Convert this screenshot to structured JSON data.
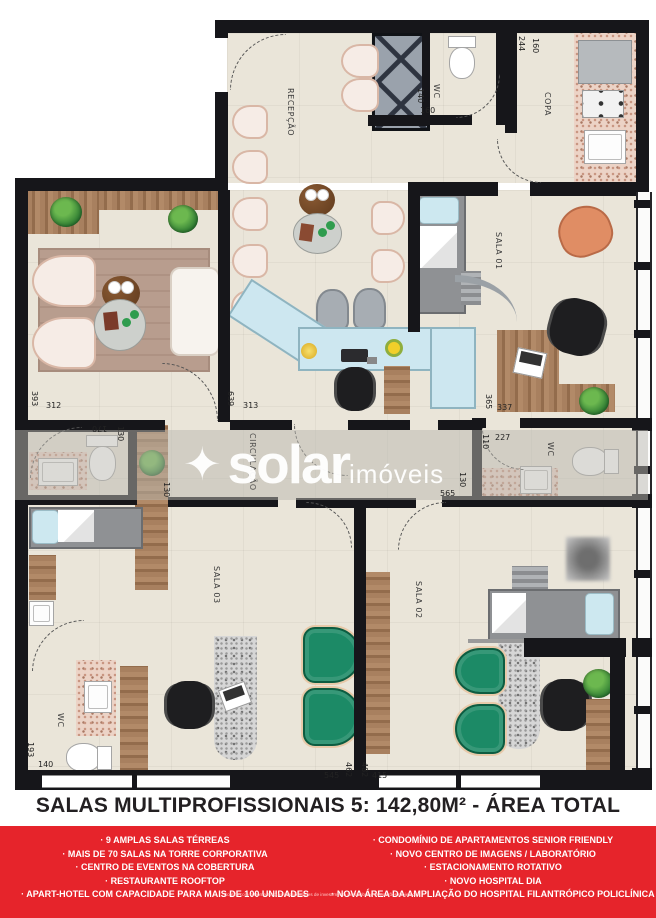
{
  "title": "SALAS MULTIPROFISSIONAIS 5: 142,80M² - ÁREA TOTAL",
  "watermark": {
    "icon": "✦",
    "brand": "solar",
    "suffix": "imóveis"
  },
  "rooms": {
    "recepcao": "RECEPÇÃO",
    "copa": "COPA",
    "wc_top": "WC",
    "sala01": "SALA 01",
    "sala02": "SALA 02",
    "sala03": "SALA 03",
    "wc_right": "WC",
    "wc_bottom": "WC",
    "circulacao": "CIRCULAÇÃO"
  },
  "dims": {
    "copa_w": "244",
    "copa_d": "160",
    "wc_top_h": "140",
    "wc_top_w": "160",
    "lounge_h": "393",
    "lounge_w": "312",
    "recep_h": "639",
    "recep_w": "313",
    "sala01_h": "365",
    "sala01_w": "337",
    "wc_right_h": "110",
    "wc_right_w": "227",
    "wc_left_w": "170",
    "wc_left_h": "130",
    "hall_left": "130",
    "hall_right": "130",
    "hall_len": "565",
    "wc_bottom_h": "193",
    "wc_bottom_w": "140",
    "bottom_a": "545",
    "bottom_b": "462",
    "bottom_c": "482",
    "bottom_d": "415"
  },
  "features": {
    "left": [
      "· 9 AMPLAS SALAS TÉRREAS",
      "· MAIS DE 70 SALAS NA TORRE CORPORATIVA",
      "· CENTRO DE EVENTOS NA COBERTURA",
      "· RESTAURANTE ROOFTOP",
      "· APART-HOTEL COM CAPACIDADE PARA MAIS DE 100 UNIDADES"
    ],
    "right": [
      "· CONDOMÍNIO DE APARTAMENTOS SENIOR FRIENDLY",
      "· NOVO CENTRO DE IMAGENS / LABORATÓRIO",
      "· ESTACIONAMENTO ROTATIVO",
      "· NOVO HOSPITAL DIA",
      "· NOVA ÁREA DA AMPLIAÇÃO DO HOSPITAL FILANTRÓPICO POLICLÍNICA"
    ]
  },
  "footnote": "*Confira com o Home Sítio as possibilidades de investimento nesta obra e os padrões projetados.",
  "colors": {
    "banner_red": "#E6242B",
    "wall": "#16161A",
    "floor": "#EAE5D9",
    "wood": "#A07A58",
    "green_chair": "#1C8A66",
    "desk_blue": "#CDE7F0",
    "granite_pink": "#ECD3C6"
  }
}
